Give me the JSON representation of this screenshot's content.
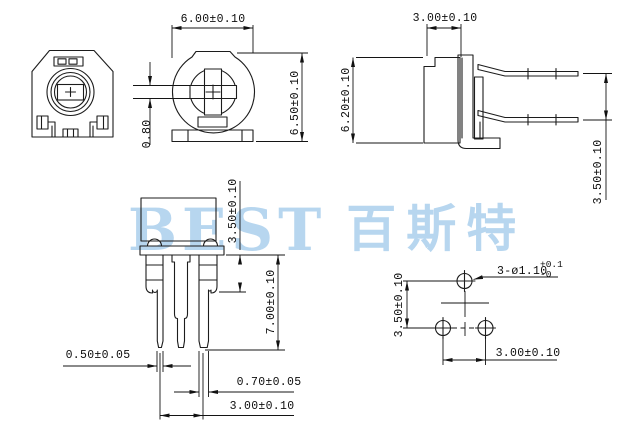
{
  "drawing": {
    "background": "#ffffff",
    "line_color": "#1c1c1c",
    "watermark": {
      "latin": "BEST",
      "cjk": "百斯特",
      "color": "#b7d6ef"
    },
    "views": {
      "front": {
        "width": "6.00±0.10",
        "height": "6.50±0.10",
        "slot_width": "0.80"
      },
      "side": {
        "depth": "3.00±0.10",
        "height": "6.20±0.10",
        "pin_span": "3.50±0.10"
      },
      "front_pins": {
        "standoff": "3.50±0.10",
        "pin_length": "7.00±0.10",
        "outer_pin_width": "0.50±0.05",
        "center_pin_width": "0.70±0.05",
        "pin_pitch": "3.00±0.10"
      },
      "pcb_layout": {
        "hole_callout": "3-ø1.10",
        "hole_tol_upper": "+0.1",
        "hole_tol_lower": "-0",
        "row_spacing": "3.50±0.10",
        "column_spacing": "3.00±0.10"
      }
    }
  }
}
